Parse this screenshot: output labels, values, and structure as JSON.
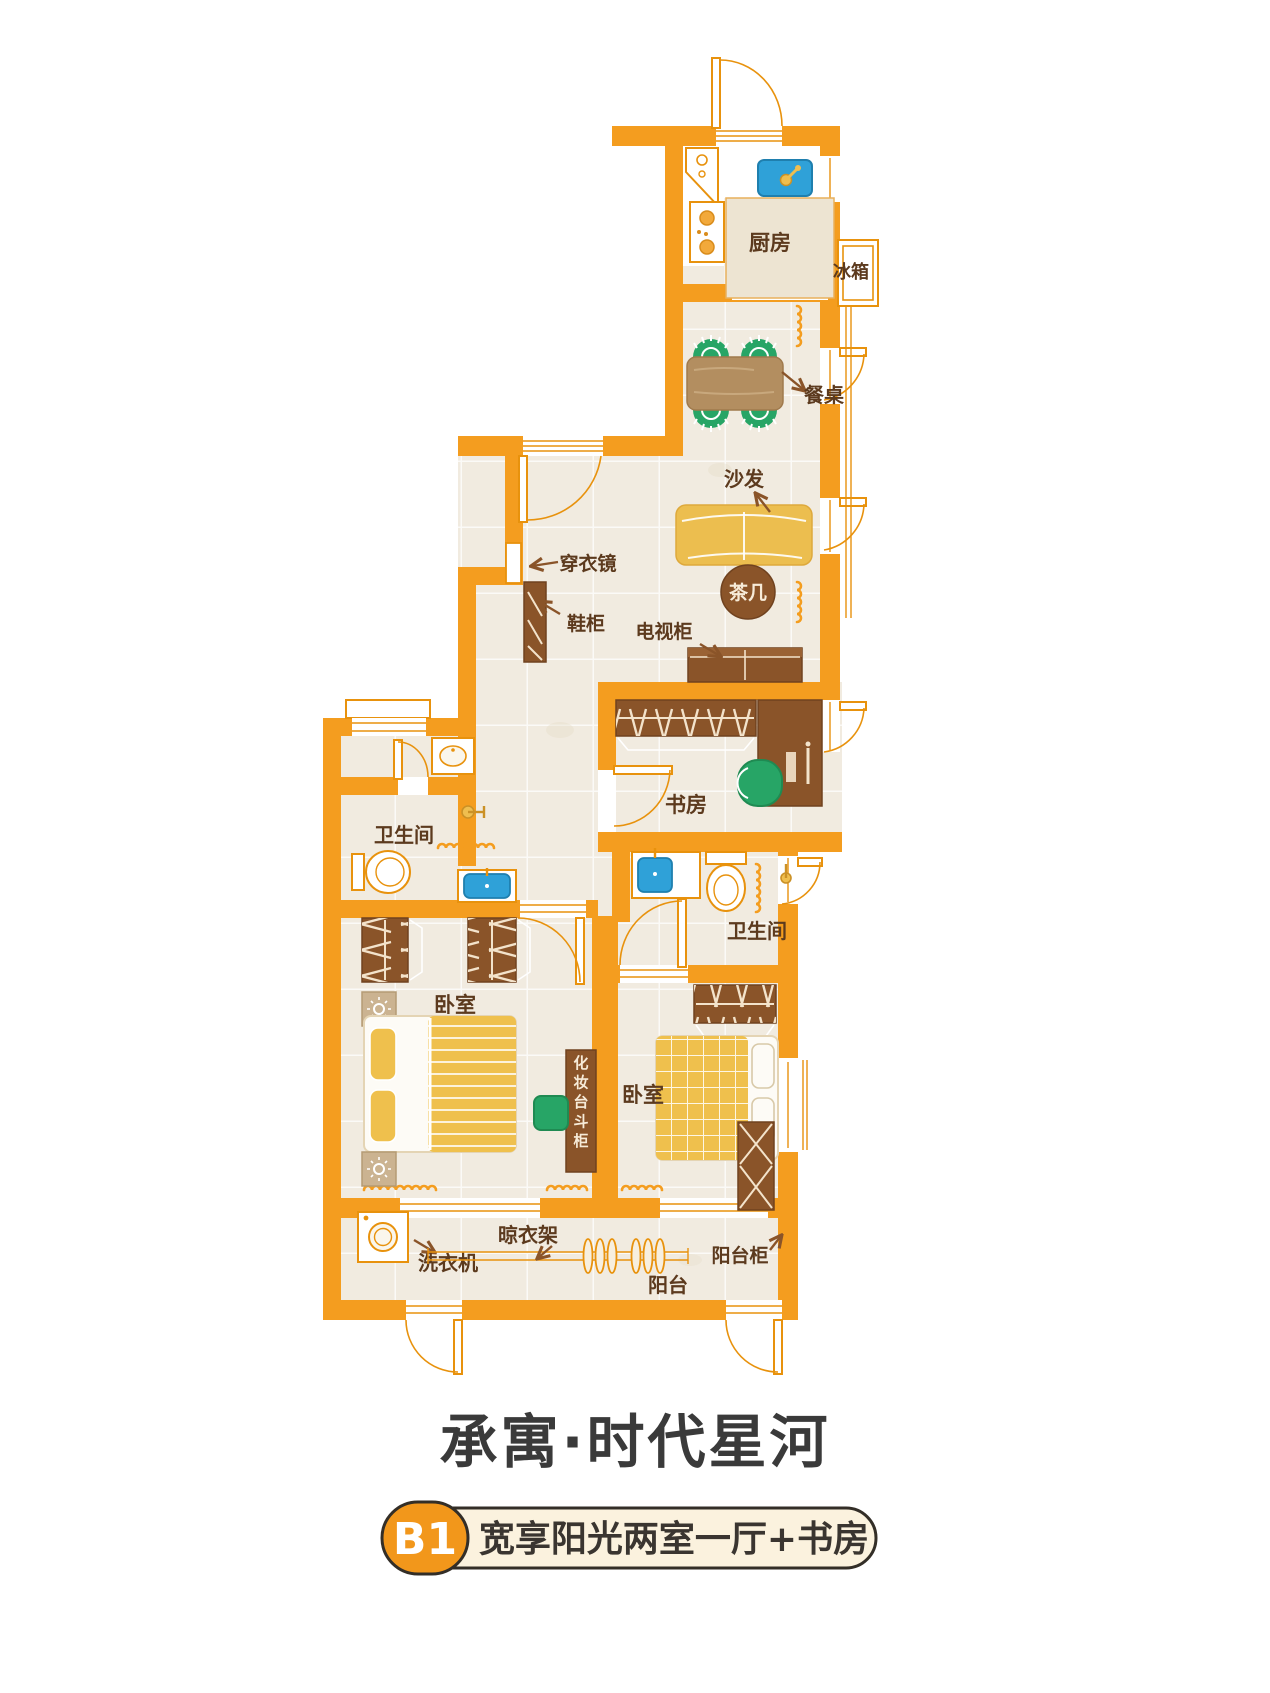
{
  "title": "承寓·时代星河",
  "badge": {
    "code": "B1",
    "description": "宽享阳光两室一厅+书房"
  },
  "rooms": {
    "kitchen": "厨房",
    "study": "书房",
    "bathroom_left": "卫生间",
    "bathroom_right": "卫生间",
    "bedroom_left": "卧室",
    "bedroom_right": "卧室",
    "balcony": "阳台"
  },
  "furniture": {
    "fridge": "冰箱",
    "dining_table": "餐桌",
    "sofa": "沙发",
    "dressing_mirror": "穿衣镜",
    "shoe_cabinet": "鞋柜",
    "tv_cabinet": "电视柜",
    "tea_table": "茶几",
    "makeup_dresser": "化妆台斗柜",
    "washing_machine": "洗衣机",
    "drying_rack": "晾衣架",
    "balcony_cabinet": "阳台柜"
  },
  "colors": {
    "wall_orange": "#F49D1F",
    "furniture_brown": "#8A5429",
    "fabric_yellow": "#EFC04D",
    "chair_green": "#27A566",
    "sink_blue": "#2FA1D8",
    "floor_beige": "#F1EBE0",
    "label_brown": "#5C3A1E",
    "badge_orange": "#F2971B",
    "badge_cream": "#FBF2DE",
    "title_gray": "#3A3A3A"
  }
}
